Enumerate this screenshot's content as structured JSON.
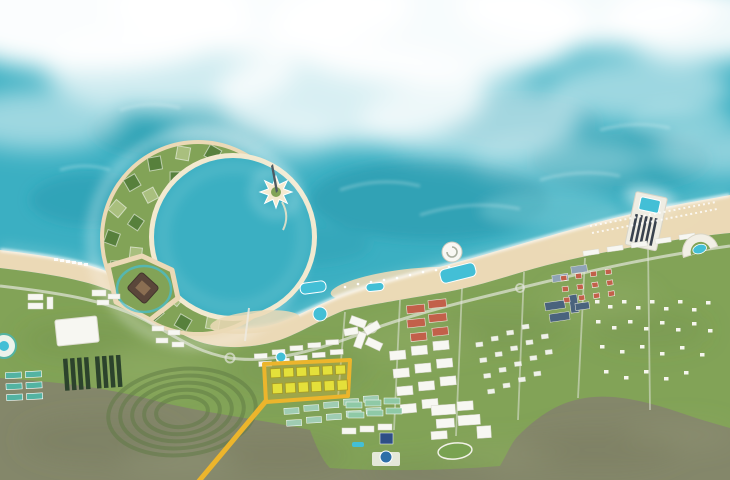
{
  "map": {
    "title": "Aerial masterplan rendering of a coastal resort city: crescent-shaped island with geometric plots, star-shaped tower island, beachfront hotel districts, inland residential grids, scrubland, and a highlighted development parcel with a yellow leader line",
    "highlight": {
      "name": "highlighted-parcel",
      "outline_color": "#ECB52C",
      "fill_color": "rgba(236,181,44,0.28)",
      "building_color": "#E4E03A",
      "leader_line": "yes"
    },
    "colors": {
      "ocean": "#3BAFC2",
      "ocean-deep": "#2697AC",
      "ocean-light": "#8FD4DC",
      "foam": "#FFFFFF",
      "sand": "#EBD9B6",
      "sand-light": "#F5EAD0",
      "green": "#82A357",
      "green-dark": "#57803C",
      "green-pale": "#A9BF7E",
      "scrub": "#84876A",
      "scrub-dark": "#6E7257",
      "road": "#E2E5DA",
      "bldg-white": "#F7F7F2",
      "bldg-red": "#C2604A",
      "bldg-teal": "#53B3A2",
      "bldg-slate": "#4A637D",
      "bldg-yellow": "#E4E03A",
      "bldg-blue": "#2E6FA8",
      "panel-dark": "#2C432C",
      "pool": "#43BFD6",
      "structure-brown": "#5A463A",
      "highlight": "#ECB52C",
      "highlight-fill": "rgba(236,181,44,0.28)"
    }
  }
}
